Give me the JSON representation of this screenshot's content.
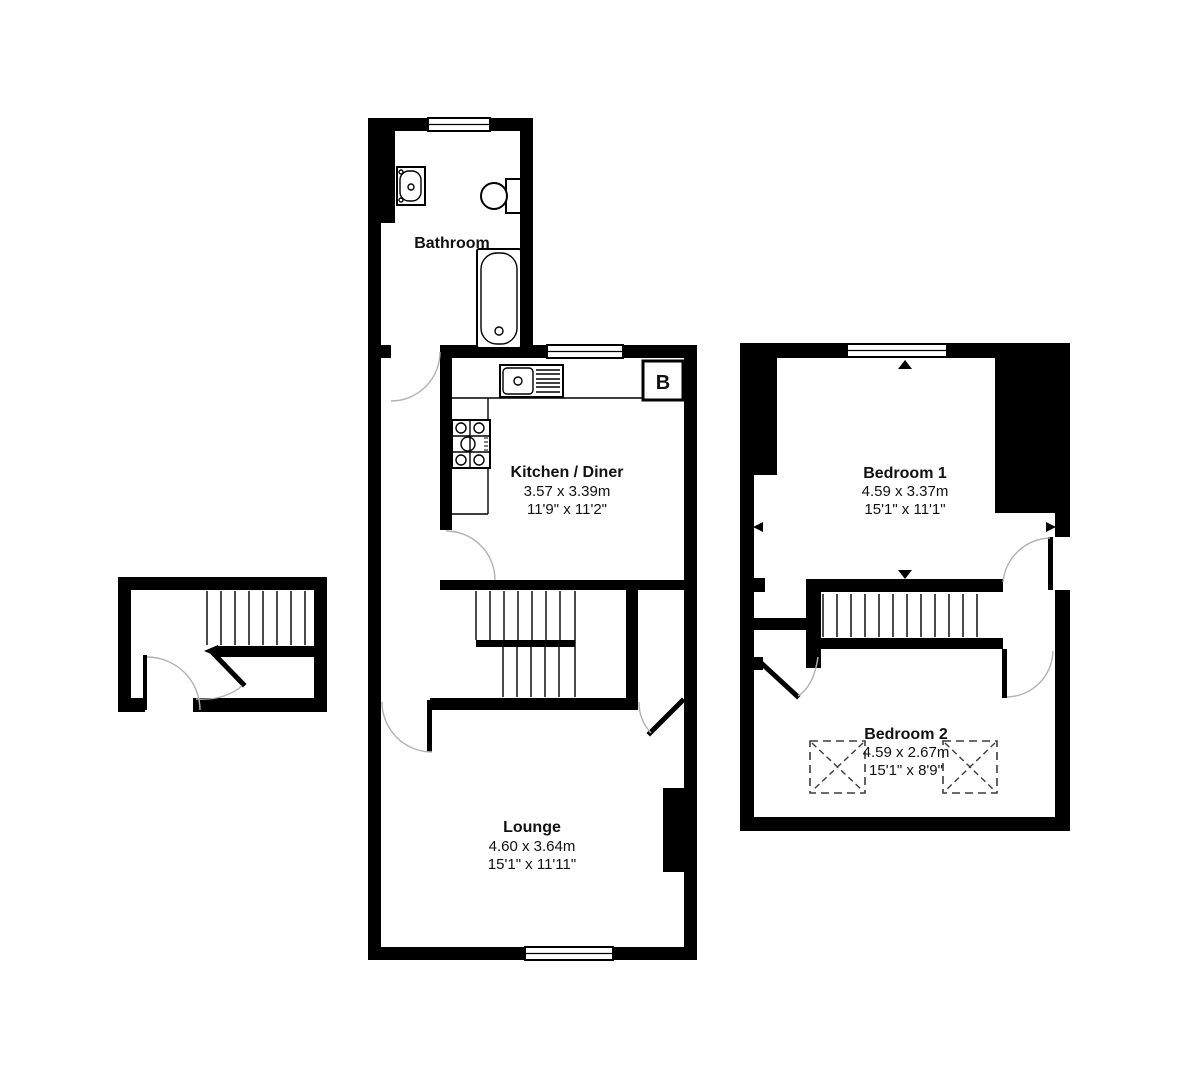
{
  "plan": {
    "rooms": {
      "bathroom": {
        "name": "Bathroom"
      },
      "kitchen_diner": {
        "name": "Kitchen / Diner",
        "metric": "3.57 x 3.39m",
        "imperial": "11'9\" x 11'2\""
      },
      "lounge": {
        "name": "Lounge",
        "metric": "4.60 x 3.64m",
        "imperial": "15'1\" x 11'11\""
      },
      "bedroom_1": {
        "name": "Bedroom 1",
        "metric": "4.59 x 3.37m",
        "imperial": "15'1\" x 11'1\""
      },
      "bedroom_2": {
        "name": "Bedroom 2",
        "metric": "4.59 x 2.67m",
        "imperial": "15'1\" x 8'9\""
      }
    },
    "annotations": {
      "boiler": "B"
    },
    "colors": {
      "wall": "#000000",
      "background": "#ffffff",
      "door_arc": "#b2b2b2",
      "dashed_marker": "#3c3c3c",
      "text": "#111111"
    }
  }
}
